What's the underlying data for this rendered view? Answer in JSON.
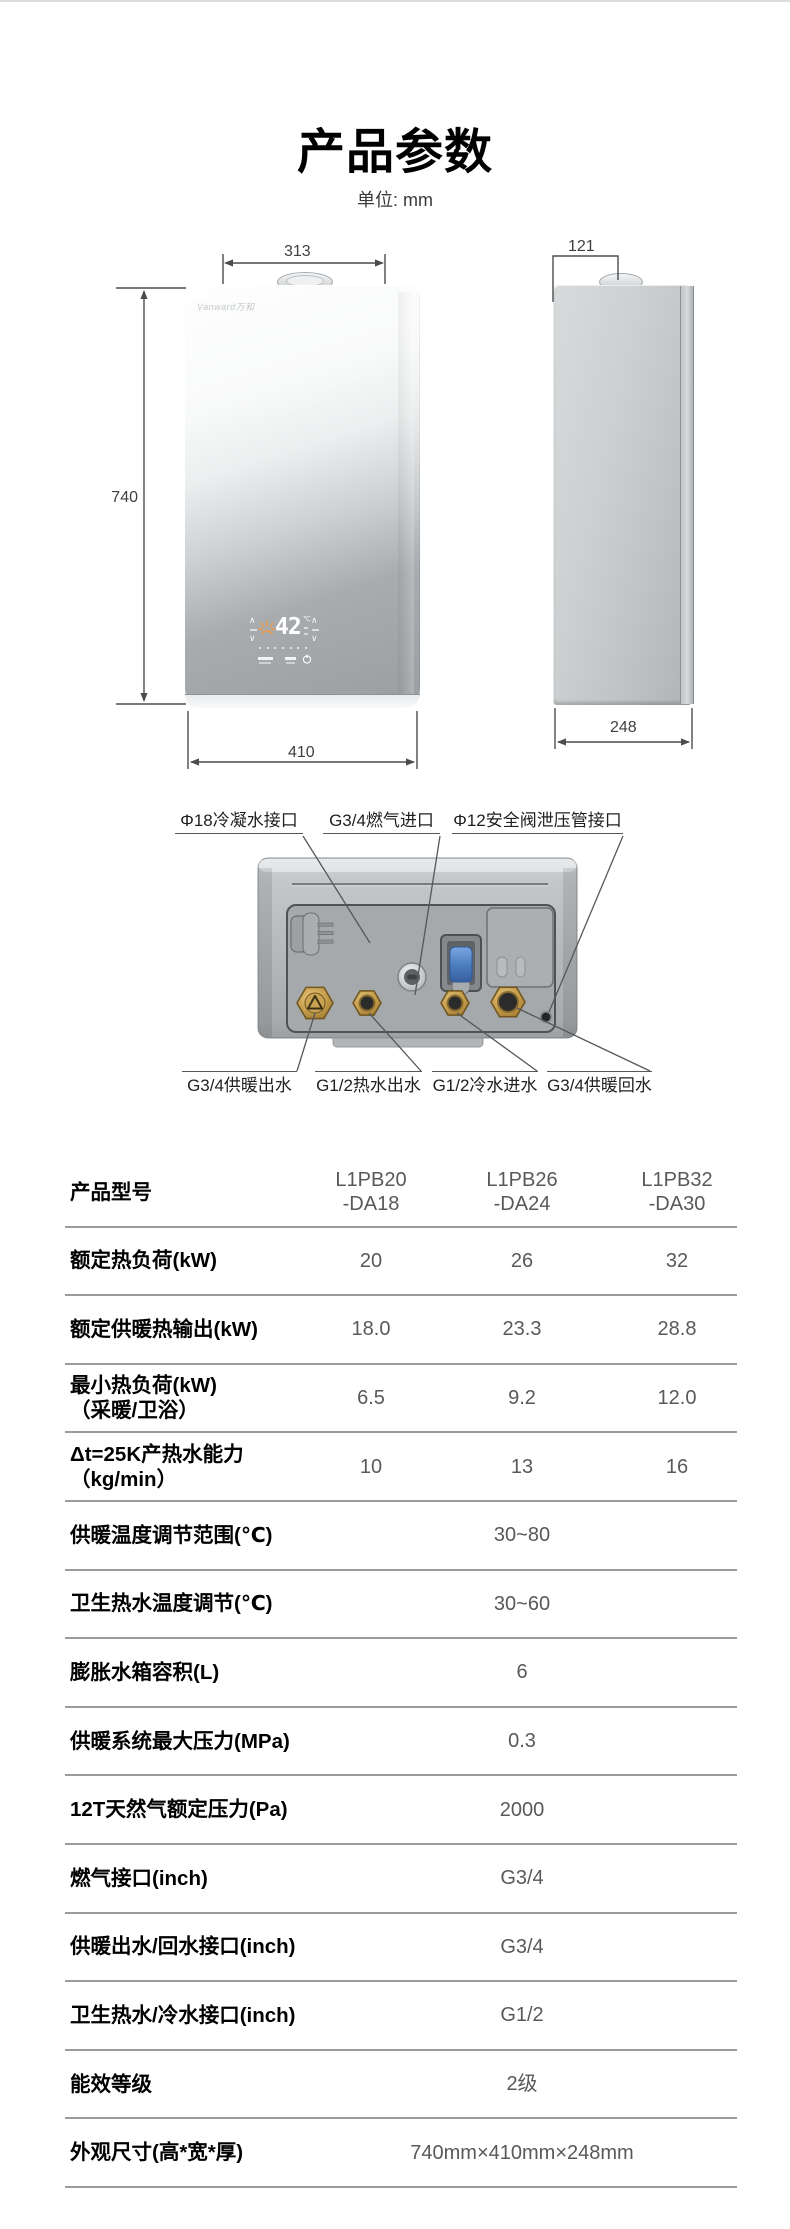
{
  "page": {
    "title": "产品参数",
    "unit_note": "单位: mm"
  },
  "colors": {
    "flame_accent": "#e89a4e",
    "brass_fitting": "#bd9245",
    "valve_blue": "#4d7fc0",
    "table_line": "#9b9b9d"
  },
  "front_view": {
    "logo": "Vanward万和",
    "display_value": "42",
    "display_unit": "℃",
    "chevron_up": "∧",
    "chevron_down": "∨",
    "dim_top": "313",
    "dim_height": "740",
    "dim_bottom": "410"
  },
  "side_view": {
    "dim_top": "121",
    "dim_bottom": "248"
  },
  "bottom_view": {
    "top_labels": [
      "Φ18冷凝水接口",
      "G3/4燃气进口",
      "Φ12安全阀泄压管接口"
    ],
    "bottom_labels": [
      "G3/4供暖出水",
      "G1/2热水出水",
      "G1/2冷水进水",
      "G3/4供暖回水"
    ]
  },
  "spec_table": {
    "header": {
      "label": "产品型号",
      "models": [
        {
          "line1": "L1PB20",
          "line2": "-DA18"
        },
        {
          "line1": "L1PB26",
          "line2": "-DA24"
        },
        {
          "line1": "L1PB32",
          "line2": "-DA30"
        }
      ]
    },
    "rows": [
      {
        "label": "额定热负荷(kW)",
        "values": [
          "20",
          "26",
          "32"
        ]
      },
      {
        "label": "额定供暖热输出(kW)",
        "values": [
          "18.0",
          "23.3",
          "28.8"
        ]
      },
      {
        "label": "最小热负荷(kW)",
        "label2": "（采暖/卫浴）",
        "values": [
          "6.5",
          "9.2",
          "12.0"
        ]
      },
      {
        "label": "Δt=25K产热水能力",
        "label2": "（kg/min）",
        "values": [
          "10",
          "13",
          "16"
        ]
      },
      {
        "label": "供暖温度调节范围(℃)",
        "span": "30~80"
      },
      {
        "label": "卫生热水温度调节(℃)",
        "span": "30~60"
      },
      {
        "label": "膨胀水箱容积(L)",
        "span": "6"
      },
      {
        "label": "供暖系统最大压力(MPa)",
        "span": "0.3"
      },
      {
        "label": "12T天然气额定压力(Pa)",
        "span": "2000"
      },
      {
        "label": "燃气接口(inch)",
        "span": "G3/4"
      },
      {
        "label": "供暖出水/回水接口(inch)",
        "span": "G3/4"
      },
      {
        "label": "卫生热水/冷水接口(inch)",
        "span": "G1/2"
      },
      {
        "label": "能效等级",
        "span": "2级"
      },
      {
        "label": "外观尺寸(高*宽*厚)",
        "span": "740mm×410mm×248mm"
      }
    ]
  }
}
